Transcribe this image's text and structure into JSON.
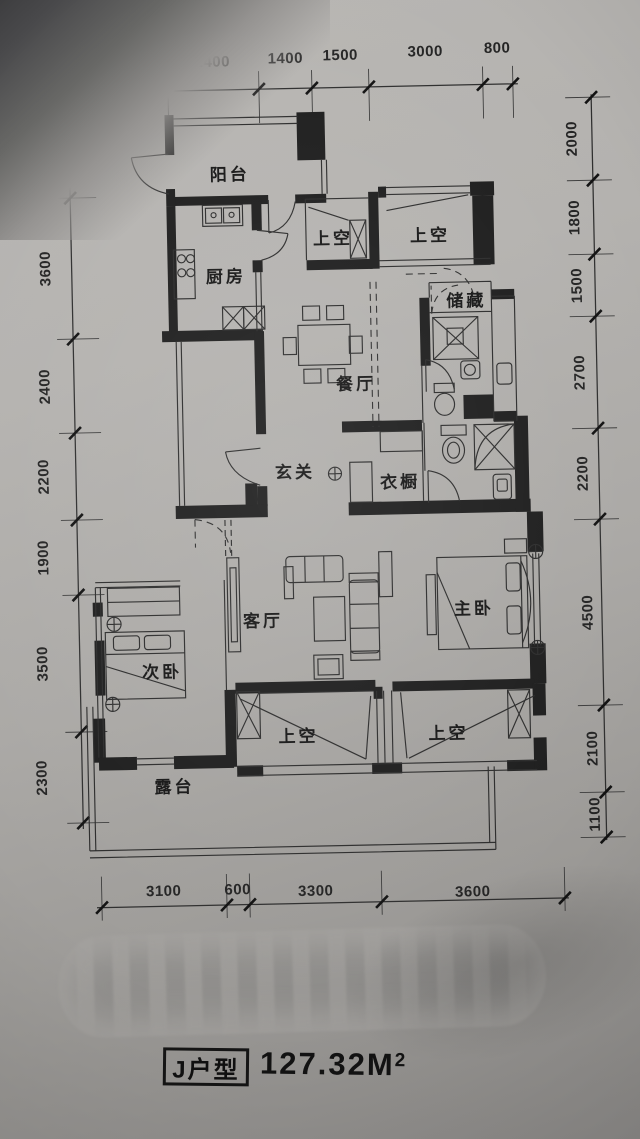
{
  "title": {
    "unit_label": "J户型",
    "area_value": "127.32M",
    "area_exponent": "2"
  },
  "dims": {
    "top": [
      "2400",
      "1400",
      "1500",
      "3000",
      "800"
    ],
    "left": [
      "2000",
      "3600",
      "2400",
      "2200",
      "1900",
      "3500",
      "2300"
    ],
    "right": [
      "2000",
      "1800",
      "1500",
      "2700",
      "2200",
      "4500",
      "2100",
      "1100"
    ],
    "bottom": [
      "3100",
      "600",
      "3300",
      "3600"
    ]
  },
  "rooms": {
    "balcony": "阳台",
    "kitchen": "厨房",
    "void_top_left": "上空",
    "void_top_right": "上空",
    "storage": "储藏",
    "dining": "餐厅",
    "foyer": "玄关",
    "wardrobe": "衣橱",
    "living": "客厅",
    "master_bedroom": "主卧",
    "second_bedroom": "次卧",
    "void_bottom_left": "上空",
    "void_bottom_right": "上空",
    "terrace": "露台"
  }
}
